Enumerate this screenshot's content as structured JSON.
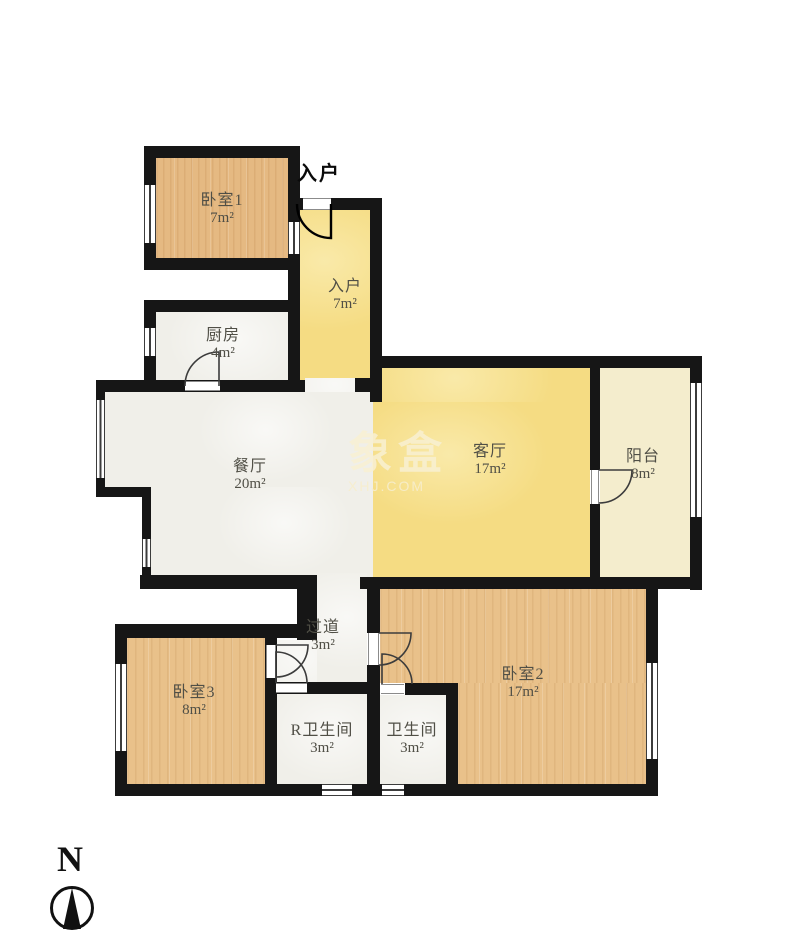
{
  "compass": {
    "label": "N"
  },
  "outside": {
    "entrance_label": "入户"
  },
  "watermark": {
    "text": "象盒",
    "subtext": "XHJ.COM"
  },
  "rooms": {
    "bedroom1": {
      "name": "卧室1",
      "area": "7m²"
    },
    "entry": {
      "name": "入户",
      "area": "7m²"
    },
    "kitchen": {
      "name": "厨房",
      "area": "4m²"
    },
    "dining": {
      "name": "餐厅",
      "area": "20m²"
    },
    "living": {
      "name": "客厅",
      "area": "17m²"
    },
    "balcony": {
      "name": "阳台",
      "area": "8m²"
    },
    "bedroom2": {
      "name": "卧室2",
      "area": "17m²"
    },
    "bedroom3": {
      "name": "卧室3",
      "area": "8m²"
    },
    "corridor": {
      "name": "过道",
      "area": "3m²"
    },
    "bathroom1": {
      "name": "R卫生间",
      "area": "3m²"
    },
    "bathroom2": {
      "name": "卫生间",
      "area": "3m²"
    }
  },
  "colors": {
    "wall": "#161616",
    "wood_floor": "#e9c18a",
    "yellow_floor": "#f5dc83",
    "cream_floor": "#f4edcd",
    "light_floor": "#f0efe9",
    "label_text": "#504f46"
  }
}
